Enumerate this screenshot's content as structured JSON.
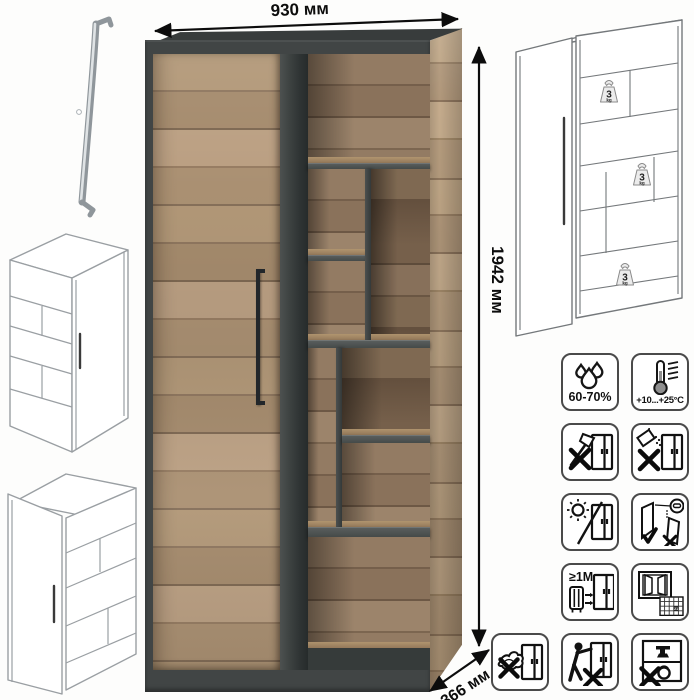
{
  "dimensions": {
    "width_label": "930 мм",
    "height_label": "1942 мм",
    "depth_label": "366 мм"
  },
  "load_badge": {
    "number": "3",
    "unit": "kg"
  },
  "care_icons": [
    {
      "name": "humidity-icon",
      "label": "60-70%"
    },
    {
      "name": "temperature-icon",
      "label": "+10...+25°C"
    },
    {
      "name": "no-sharp-tools-icon"
    },
    {
      "name": "no-spilling-icon"
    },
    {
      "name": "no-direct-sunlight-icon"
    },
    {
      "name": "close-doors-gently-icon"
    },
    {
      "name": "heat-distance-icon",
      "label": "≥1M"
    },
    {
      "name": "ventilate-acclimatize-icon",
      "label": "21"
    },
    {
      "name": "no-wet-cleaning-icon"
    },
    {
      "name": "no-dragging-icon"
    },
    {
      "name": "no-overloading-icon"
    }
  ],
  "colors": {
    "wood_light": "#b59b7d",
    "wood_dark": "#8a7159",
    "graphite": "#414545",
    "handle": "#22262a",
    "icon_stroke": "#111111"
  }
}
